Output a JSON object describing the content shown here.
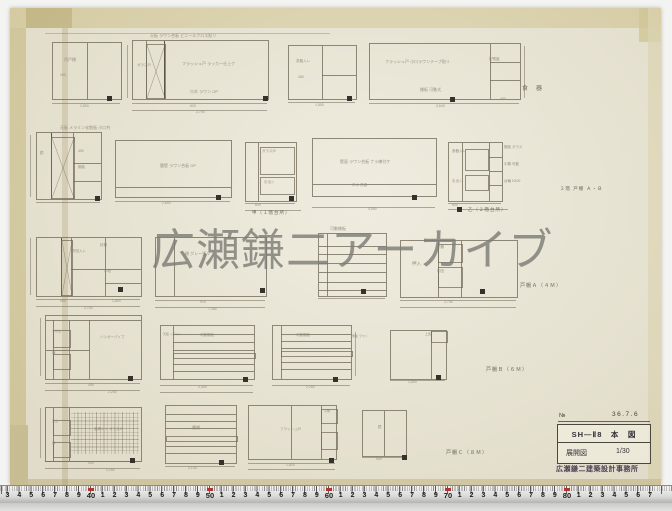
{
  "watermark": {
    "text": "広瀬鎌二アーカイブ"
  },
  "title_block": {
    "no_label": "№",
    "date": "36.7.6",
    "title_line": "SH—Ⅱ8　本　図",
    "drawing_type": "展開図",
    "scale": "1/30",
    "office_stamp": "広瀬鎌二建築設計事務所"
  },
  "ruler": {
    "marks": [
      "3",
      "4",
      "5",
      "6",
      "7",
      "8",
      "9",
      "40",
      "1",
      "2",
      "3",
      "4",
      "5",
      "6",
      "7",
      "8",
      "9",
      "50",
      "1",
      "2",
      "3",
      "4",
      "5",
      "6",
      "7",
      "8",
      "9",
      "60",
      "1",
      "2",
      "3",
      "4",
      "5",
      "6",
      "7",
      "8",
      "9",
      "70",
      "1",
      "2",
      "3",
      "4",
      "5",
      "6",
      "7",
      "8",
      "9",
      "80",
      "1",
      "2",
      "3",
      "4",
      "5",
      "6",
      "7"
    ]
  },
  "drawing": {
    "cabinets": [
      {
        "x": 52,
        "y": 42,
        "w": 68,
        "h": 56,
        "lines": [
          [
            "v",
            34,
            0,
            56
          ]
        ]
      },
      {
        "x": 132,
        "y": 40,
        "w": 135,
        "h": 58,
        "lines": [
          [
            "v",
            13,
            0,
            58
          ],
          [
            "v",
            31,
            0,
            58,
            1
          ]
        ],
        "cross": [
          [
            13,
            3,
            18,
            53
          ]
        ]
      },
      {
        "x": 288,
        "y": 45,
        "w": 67,
        "h": 53,
        "lines": [
          [
            "v",
            33,
            0,
            53
          ],
          [
            "h",
            29,
            33,
            67
          ]
        ]
      },
      {
        "x": 369,
        "y": 43,
        "w": 150,
        "h": 55,
        "lines": [
          [
            "v",
            120,
            0,
            55
          ],
          [
            "h",
            18,
            120,
            150
          ],
          [
            "h",
            36,
            120,
            150
          ]
        ]
      },
      {
        "x": 36,
        "y": 132,
        "w": 64,
        "h": 66,
        "lines": [
          [
            "v",
            14,
            0,
            66,
            1
          ],
          [
            "v",
            36,
            0,
            66
          ],
          [
            "h",
            30,
            36,
            64
          ],
          [
            "h",
            48,
            36,
            64
          ]
        ],
        "cross": [
          [
            14,
            4,
            22,
            60
          ]
        ]
      },
      {
        "x": 115,
        "y": 140,
        "w": 115,
        "h": 56,
        "lines": [
          [
            "h",
            46,
            0,
            115
          ]
        ]
      },
      {
        "x": 245,
        "y": 142,
        "w": 50,
        "h": 58,
        "lines": [
          [
            "v",
            12,
            0,
            58
          ]
        ],
        "boxes": [
          [
            14,
            4,
            33,
            26
          ],
          [
            14,
            34,
            33,
            16
          ]
        ]
      },
      {
        "x": 312,
        "y": 138,
        "w": 123,
        "h": 57,
        "lines": [
          [
            "h",
            45,
            0,
            123
          ]
        ]
      },
      {
        "x": 448,
        "y": 142,
        "w": 53,
        "h": 58,
        "lines": [
          [
            "v",
            13,
            0,
            58
          ],
          [
            "v",
            40,
            0,
            58
          ],
          [
            "h",
            14,
            40,
            53
          ],
          [
            "h",
            28,
            40,
            53
          ],
          [
            "h",
            42,
            40,
            53
          ]
        ],
        "boxes": [
          [
            16,
            6,
            22,
            20
          ],
          [
            16,
            32,
            22,
            14
          ]
        ]
      },
      {
        "x": 36,
        "y": 237,
        "w": 104,
        "h": 58,
        "lines": [
          [
            "v",
            24,
            0,
            58,
            1
          ],
          [
            "v",
            34,
            0,
            58
          ],
          [
            "v",
            68,
            0,
            58
          ],
          [
            "h",
            31,
            34,
            104
          ],
          [
            "h",
            45,
            68,
            104
          ]
        ],
        "cross": [
          [
            24,
            2,
            10,
            54
          ]
        ]
      },
      {
        "x": 155,
        "y": 237,
        "w": 110,
        "h": 58,
        "lines": [
          [
            "v",
            18,
            0,
            58
          ]
        ]
      },
      {
        "x": 318,
        "y": 233,
        "w": 67,
        "h": 62,
        "lines": [
          [
            "v",
            8,
            0,
            62
          ],
          [
            "h",
            12,
            0,
            67
          ],
          [
            "h",
            20,
            0,
            67
          ],
          [
            "h",
            29,
            0,
            67
          ],
          [
            "h",
            38,
            0,
            67
          ],
          [
            "h",
            48,
            0,
            67
          ],
          [
            "h",
            56,
            0,
            67
          ]
        ]
      },
      {
        "x": 400,
        "y": 240,
        "w": 116,
        "h": 56,
        "lines": [
          [
            "v",
            37,
            0,
            56
          ],
          [
            "v",
            60,
            0,
            56
          ]
        ],
        "boxes": [
          [
            37,
            3,
            23,
            17
          ],
          [
            37,
            26,
            23,
            19
          ]
        ]
      },
      {
        "x": 45,
        "y": 315,
        "w": 95,
        "h": 63,
        "lines": [
          [
            "h",
            4,
            0,
            95
          ],
          [
            "v",
            7,
            4,
            63
          ],
          [
            "v",
            23,
            4,
            63
          ],
          [
            "v",
            43,
            4,
            63
          ],
          [
            "h",
            34,
            0,
            43
          ]
        ],
        "boxes": [
          [
            7,
            14,
            16,
            16
          ],
          [
            7,
            38,
            16,
            14
          ]
        ]
      },
      {
        "x": 160,
        "y": 325,
        "w": 93,
        "h": 53,
        "lines": [
          [
            "v",
            12,
            0,
            53
          ],
          [
            "h",
            8,
            12,
            93
          ],
          [
            "h",
            16,
            12,
            93
          ],
          [
            "h",
            24,
            12,
            93
          ],
          [
            "h",
            38,
            12,
            93
          ],
          [
            "h",
            45,
            12,
            93
          ]
        ],
        "boxes": [
          [
            12,
            27,
            81,
            4
          ]
        ]
      },
      {
        "x": 272,
        "y": 325,
        "w": 78,
        "h": 53,
        "lines": [
          [
            "v",
            8,
            0,
            53
          ],
          [
            "h",
            8,
            8,
            78
          ],
          [
            "h",
            15,
            8,
            78
          ],
          [
            "h",
            22,
            8,
            78
          ],
          [
            "h",
            36,
            8,
            78
          ],
          [
            "h",
            43,
            8,
            78
          ]
        ],
        "boxes": [
          [
            8,
            25,
            70,
            4
          ]
        ]
      },
      {
        "x": 390,
        "y": 330,
        "w": 55,
        "h": 48,
        "lines": [
          [
            "v",
            40,
            0,
            48
          ]
        ],
        "boxes": [
          [
            40,
            0,
            15,
            10
          ]
        ]
      },
      {
        "x": 45,
        "y": 407,
        "w": 95,
        "h": 53,
        "lines": [
          [
            "v",
            7,
            0,
            53
          ],
          [
            "v",
            23,
            0,
            53
          ]
        ],
        "boxes": [
          [
            7,
            12,
            16,
            14
          ],
          [
            7,
            34,
            16,
            14
          ]
        ],
        "mesh": [
          25,
          4,
          68,
          42
        ]
      },
      {
        "x": 165,
        "y": 405,
        "w": 70,
        "h": 57,
        "lines": [
          [
            "h",
            8,
            0,
            70
          ],
          [
            "h",
            15,
            0,
            70
          ],
          [
            "h",
            22,
            0,
            70
          ],
          [
            "h",
            40,
            0,
            70
          ],
          [
            "h",
            47,
            0,
            70
          ]
        ],
        "boxes": [
          [
            0,
            30,
            70,
            4
          ]
        ]
      },
      {
        "x": 248,
        "y": 405,
        "w": 87,
        "h": 53,
        "lines": [
          [
            "v",
            42,
            0,
            53
          ],
          [
            "v",
            72,
            0,
            53
          ]
        ],
        "boxes": [
          [
            72,
            3,
            15,
            13
          ],
          [
            72,
            26,
            15,
            16
          ]
        ]
      },
      {
        "x": 362,
        "y": 410,
        "w": 43,
        "h": 45,
        "lines": [
          [
            "v",
            21,
            0,
            45
          ]
        ]
      }
    ],
    "dims": [
      [
        45,
        33,
        285,
        1
      ],
      [
        52,
        103,
        68
      ],
      [
        132,
        103,
        135
      ],
      [
        132,
        110,
        135
      ],
      [
        288,
        102,
        67
      ],
      [
        369,
        103,
        150
      ],
      [
        36,
        202,
        64
      ],
      [
        115,
        201,
        115
      ],
      [
        245,
        203,
        50
      ],
      [
        245,
        210,
        56
      ],
      [
        312,
        207,
        123
      ],
      [
        448,
        203,
        53
      ],
      [
        448,
        209,
        60
      ],
      [
        36,
        299,
        104
      ],
      [
        36,
        306,
        104
      ],
      [
        155,
        300,
        110
      ],
      [
        155,
        307,
        110
      ],
      [
        318,
        298,
        67
      ],
      [
        400,
        300,
        116
      ],
      [
        400,
        307,
        116
      ],
      [
        45,
        383,
        95
      ],
      [
        45,
        390,
        95
      ],
      [
        160,
        385,
        93
      ],
      [
        160,
        392,
        93
      ],
      [
        272,
        385,
        78
      ],
      [
        390,
        380,
        55
      ],
      [
        45,
        461,
        95
      ],
      [
        45,
        468,
        95
      ],
      [
        165,
        466,
        70
      ],
      [
        248,
        463,
        87
      ],
      [
        248,
        469,
        87
      ],
      [
        362,
        457,
        43
      ]
    ],
    "vdims": [
      [
        127,
        45,
        53
      ],
      [
        30,
        135,
        62
      ],
      [
        30,
        238,
        57
      ],
      [
        40,
        318,
        58
      ],
      [
        40,
        408,
        50
      ],
      [
        524,
        46,
        52
      ],
      [
        355,
        332,
        44
      ]
    ],
    "stamps": [
      [
        107,
        96
      ],
      [
        263,
        96
      ],
      [
        347,
        96
      ],
      [
        450,
        97
      ],
      [
        95,
        196
      ],
      [
        216,
        195
      ],
      [
        289,
        196
      ],
      [
        412,
        195
      ],
      [
        457,
        207
      ],
      [
        118,
        287
      ],
      [
        260,
        288
      ],
      [
        361,
        289
      ],
      [
        480,
        289
      ],
      [
        128,
        376
      ],
      [
        243,
        377
      ],
      [
        333,
        377
      ],
      [
        436,
        375
      ],
      [
        130,
        458
      ],
      [
        219,
        460
      ],
      [
        329,
        458
      ],
      [
        402,
        455
      ]
    ],
    "notes": [
      [
        64,
        58,
        "吊戸棚",
        4
      ],
      [
        60,
        74,
        "450",
        3.5
      ],
      [
        150,
        34,
        "天板 ラワン合板 ビニールクロス貼リ",
        4
      ],
      [
        137,
        64,
        "ガラス戸",
        3.5
      ],
      [
        182,
        62,
        "フラッシュ戸 ラッカー仕上ゲ",
        4
      ],
      [
        190,
        90,
        "巾木 ラワン OP",
        4
      ],
      [
        296,
        60,
        "茶器入レ",
        3.5
      ],
      [
        298,
        76,
        "450",
        3.5
      ],
      [
        385,
        60,
        "フラッシュ戸 小口ラワンテープ貼リ",
        4
      ],
      [
        420,
        88,
        "棚板 可動式",
        4
      ],
      [
        489,
        58,
        "配電盤",
        3.5
      ],
      [
        80,
        105,
        "1,800",
        3.5
      ],
      [
        190,
        105,
        "600",
        3.5
      ],
      [
        196,
        111,
        "2,700",
        3.5
      ],
      [
        315,
        104,
        "1,500",
        3.5
      ],
      [
        436,
        105,
        "3,640",
        3.5
      ],
      [
        500,
        98,
        "450",
        3.5
      ],
      [
        60,
        126,
        "天板 メラミン化粧板 小口共",
        4
      ],
      [
        40,
        152,
        "鏡",
        3.5
      ],
      [
        78,
        150,
        "450",
        3.5
      ],
      [
        78,
        166,
        "棚板",
        3.5
      ],
      [
        160,
        164,
        "腰壁 ラワン合板 OP",
        4
      ],
      [
        162,
        202,
        "2,600",
        3.5
      ],
      [
        262,
        150,
        "ガラス戸",
        3.5
      ],
      [
        264,
        181,
        "引出シ",
        3.5
      ],
      [
        255,
        204,
        "600",
        3.5
      ],
      [
        340,
        160,
        "壁面 ラワン合板 ナラ練付ケ",
        4
      ],
      [
        352,
        184,
        "巾木 共通",
        3.5
      ],
      [
        368,
        208,
        "4,550",
        3.5
      ],
      [
        452,
        150,
        "食器入レ",
        3.5
      ],
      [
        452,
        180,
        "引出シ",
        3.5
      ],
      [
        504,
        146,
        "棚板 ガラス",
        3.5
      ],
      [
        504,
        163,
        "中棚 可動",
        3.5
      ],
      [
        504,
        180,
        "台輪 H100",
        3.5
      ],
      [
        452,
        204,
        "600",
        3.5
      ],
      [
        72,
        250,
        "布団入レ",
        3.5
      ],
      [
        100,
        244,
        "枕棚",
        3.5
      ],
      [
        104,
        270,
        "中段",
        3.5
      ],
      [
        60,
        300,
        "900",
        3.5
      ],
      [
        112,
        300,
        "1,800",
        3.5
      ],
      [
        84,
        307,
        "2,700",
        3.5
      ],
      [
        185,
        252,
        "襖 グレー張リ",
        4
      ],
      [
        200,
        301,
        "910",
        3.5
      ],
      [
        208,
        308,
        "7,280",
        3.5
      ],
      [
        330,
        227,
        "可動棚板",
        4
      ],
      [
        437,
        246,
        "枕棚",
        3.5
      ],
      [
        412,
        262,
        "押入",
        4.5
      ],
      [
        437,
        270,
        "布団",
        3.5
      ],
      [
        444,
        301,
        "2,730",
        3.5
      ],
      [
        52,
        330,
        "小引出",
        3
      ],
      [
        52,
        352,
        "扉",
        3.5
      ],
      [
        100,
        336,
        "ハンガーパイプ",
        3.5
      ],
      [
        88,
        384,
        "450",
        3.5
      ],
      [
        108,
        391,
        "2,250",
        3.5
      ],
      [
        163,
        333,
        "天板 メラミン",
        3
      ],
      [
        200,
        334,
        "可動棚板",
        3.5
      ],
      [
        198,
        386,
        "2,400",
        3.5
      ],
      [
        296,
        334,
        "可動棚板",
        3.5
      ],
      [
        352,
        335,
        "側板 ラワン",
        3
      ],
      [
        306,
        386,
        "2,250",
        3.5
      ],
      [
        425,
        333,
        "上置",
        3
      ],
      [
        408,
        381,
        "1,500",
        3.5
      ],
      [
        52,
        420,
        "引出",
        3
      ],
      [
        52,
        442,
        "扉",
        3.5
      ],
      [
        94,
        428,
        "金網入リ ガラス戸",
        3.5
      ],
      [
        88,
        462,
        "450",
        3.5
      ],
      [
        106,
        469,
        "2,250",
        3.5
      ],
      [
        192,
        426,
        "書棚",
        4
      ],
      [
        188,
        467,
        "2,130",
        3.5
      ],
      [
        280,
        428,
        "フラッシュ戸",
        3.5
      ],
      [
        324,
        410,
        "小物",
        3
      ],
      [
        286,
        464,
        "1,820",
        3.5
      ],
      [
        378,
        426,
        "鏡",
        3.5
      ],
      [
        376,
        458,
        "900",
        3.5
      ]
    ],
    "captions": [
      [
        522,
        86,
        "食　器",
        6
      ],
      [
        252,
        211,
        "甲（１階台所）",
        4.5
      ],
      [
        468,
        208,
        "乙（２階台所）",
        4.5
      ],
      [
        560,
        187,
        "２階 戸棚 Ａ・Ｂ",
        4.5
      ],
      [
        520,
        284,
        "戸棚Ａ（４Ｍ）",
        5
      ],
      [
        486,
        368,
        "戸棚Ｂ（６Ｍ）",
        5
      ],
      [
        446,
        451,
        "戸棚Ｃ（８Ｍ）",
        5
      ]
    ]
  }
}
